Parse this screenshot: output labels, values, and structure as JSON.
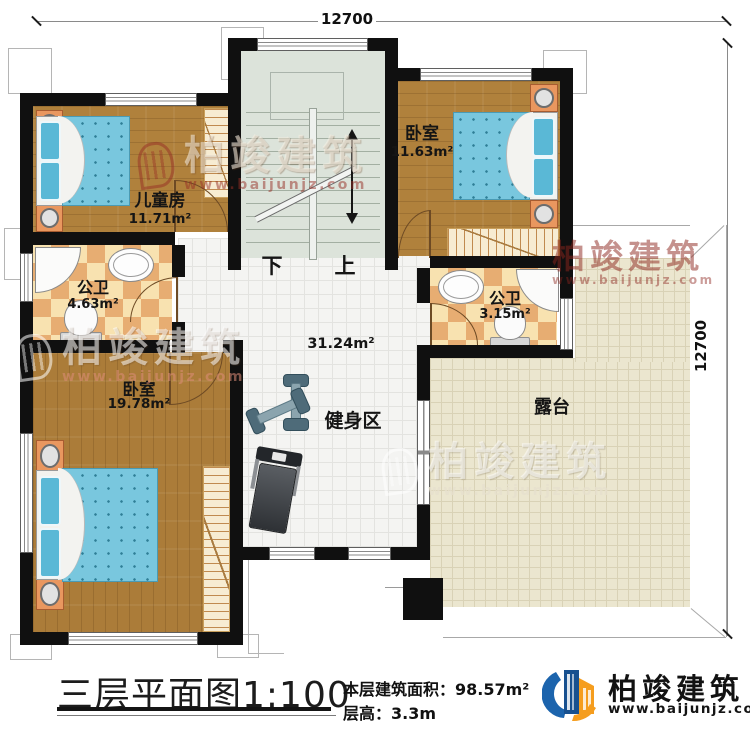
{
  "dimensions": {
    "top": "12700",
    "right": "12700"
  },
  "stairs": {
    "down_label": "下",
    "up_label": "上"
  },
  "rooms": {
    "children": {
      "name": "儿童房",
      "area": "11.71m²"
    },
    "bedroom_top": {
      "name": "卧室",
      "area": "11.63m²"
    },
    "bath_left": {
      "name": "公卫",
      "area": "4.63m²"
    },
    "bath_right": {
      "name": "公卫",
      "area": "3.15m²"
    },
    "bedroom_bottom": {
      "name": "卧室",
      "area": "19.78m²"
    },
    "hall": {
      "area": "31.24m²",
      "zone_label": "健身区"
    },
    "terrace": {
      "name": "露台"
    }
  },
  "title_block": {
    "title": "三层平面图1:100",
    "floor_area_label": "本层建筑面积：",
    "floor_area_value": "98.57m²",
    "floor_height_label": "层高：",
    "floor_height_value": "3.3m"
  },
  "brand": {
    "name": "柏竣建筑",
    "url": "www.baijunjz.com"
  },
  "watermark": {
    "name": "柏竣建筑",
    "url": "www.baijunjz.com"
  },
  "colors": {
    "wall": "#101010",
    "wood": "#b0813c",
    "bath_tile": "#e7ad72",
    "stair_floor": "#dce3da",
    "hall_tile": "#f4f4f2",
    "terrace_tile": "#ebe6cf",
    "mattress_blue": "#79c7de",
    "nightstand_orange": "#e9975f",
    "logo_blue": "#1c64ad",
    "logo_orange": "#f59d1e",
    "text_black": "#111111"
  }
}
